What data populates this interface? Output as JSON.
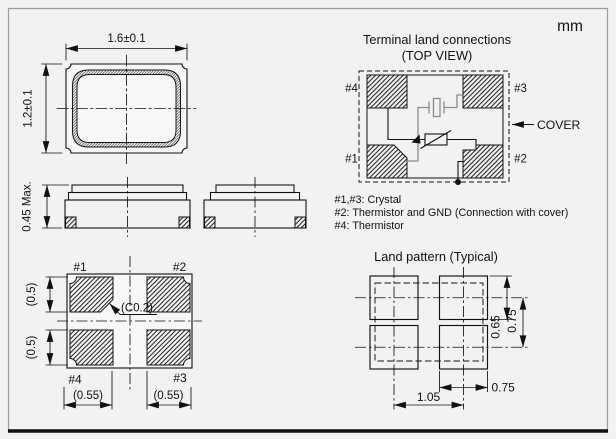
{
  "unit_label": "mm",
  "top_view": {
    "width_dim": "1.6±0.1",
    "height_dim": "1.2±0.1"
  },
  "side_views": {
    "height_dim": "0.45 Max."
  },
  "bottom_view": {
    "pad1": "#1",
    "pad2": "#2",
    "pad3": "#3",
    "pad4": "#4",
    "pad_height_dim_top": "(0.5)",
    "pad_height_dim_bottom": "(0.5)",
    "chamfer_dim": "(C0.2)",
    "pad_width_dim_left": "(0.55)",
    "pad_width_dim_right": "(0.55)"
  },
  "terminal_land_connections": {
    "title": "Terminal land connections",
    "subtitle": "(TOP VIEW)",
    "pad1": "#1",
    "pad2": "#2",
    "pad3": "#3",
    "pad4": "#4",
    "cover_label": "COVER",
    "notes": [
      "#1,#3: Crystal",
      "#2: Thermistor and GND (Connection with cover)",
      "#4: Thermistor"
    ]
  },
  "land_pattern": {
    "title": "Land pattern (Typical)",
    "pad_height_dim": "0.65",
    "row_pitch_dim": "0.75",
    "pad_width_dim": "0.75",
    "column_pitch_dim": "1.05"
  },
  "colors": {
    "line": "#111111",
    "crystal_symbol": "#8a8a8a",
    "background": "#f2f2f0",
    "frame_border": "#9a9a9a"
  }
}
